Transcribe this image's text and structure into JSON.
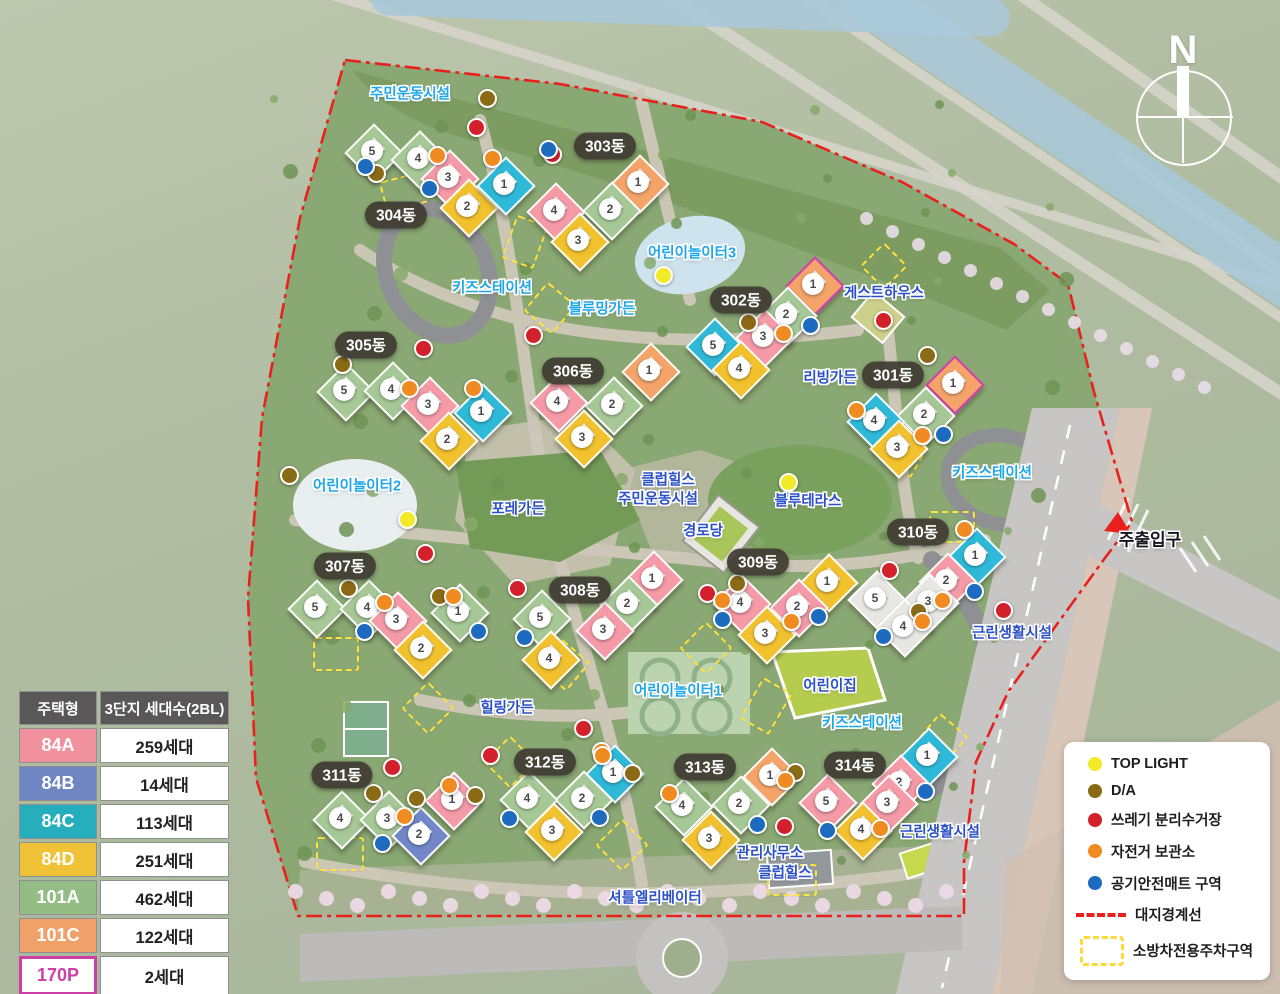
{
  "compass": {
    "letter": "N"
  },
  "unit_table": {
    "headers": [
      "주택형",
      "3단지 세대수(2BL)"
    ],
    "rows": [
      {
        "type": "84A",
        "count": "259세대",
        "color": "#f2919e",
        "text_color": "#ffffff"
      },
      {
        "type": "84B",
        "count": "14세대",
        "color": "#6f86c3",
        "text_color": "#ffffff"
      },
      {
        "type": "84C",
        "count": "113세대",
        "color": "#27aebd",
        "text_color": "#ffffff"
      },
      {
        "type": "84D",
        "count": "251세대",
        "color": "#f0c238",
        "text_color": "#ffffff"
      },
      {
        "type": "101A",
        "count": "462세대",
        "color": "#93bd85",
        "text_color": "#ffffff"
      },
      {
        "type": "101C",
        "count": "122세대",
        "color": "#f0a16a",
        "text_color": "#ffffff"
      },
      {
        "type": "170P",
        "count": "2세대",
        "color": "#ffffff",
        "text_color": "#cc3fa5",
        "border": "#cc3fa5"
      }
    ],
    "footer": "일반분양 1,223세대"
  },
  "legend": {
    "items": [
      {
        "kind": "dot",
        "color": "#f2ea29",
        "label": "TOP LIGHT"
      },
      {
        "kind": "dot",
        "color": "#8a6a15",
        "label": "D/A"
      },
      {
        "kind": "dot",
        "color": "#d2212a",
        "label": "쓰레기 분리수거장"
      },
      {
        "kind": "dot",
        "color": "#ef8b20",
        "label": "자전거 보관소"
      },
      {
        "kind": "dot",
        "color": "#1d6bbf",
        "label": "공기안전매트 구역"
      },
      {
        "kind": "dashline",
        "color": "#e8211d",
        "label": "대지경계선"
      },
      {
        "kind": "dashbox",
        "color": "#ffd83c",
        "label": "소방차전용주차구역"
      }
    ]
  },
  "unit_type_colors": {
    "84A": "#f59aa7",
    "84B": "#7287c8",
    "84C": "#2fb9d8",
    "84D": "#f2c12e",
    "101A": "#a6c896",
    "101C": "#f4a469",
    "170P": "#f4a469",
    "roof": "#e9e7e3"
  },
  "p170_border": "#cf3fae",
  "boundary_color": "#e8211d",
  "amenity_labels": [
    {
      "text": "주민운동시설",
      "x": 410,
      "y": 93,
      "style": "cyan"
    },
    {
      "text": "어린이놀이터3",
      "x": 692,
      "y": 252,
      "style": "cyan"
    },
    {
      "text": "키즈스테이션",
      "x": 492,
      "y": 287,
      "style": "cyan"
    },
    {
      "text": "블루밍가든",
      "x": 602,
      "y": 308,
      "style": "cyan"
    },
    {
      "text": "게스트하우스",
      "x": 884,
      "y": 292,
      "style": "blue"
    },
    {
      "text": "리빙가든",
      "x": 830,
      "y": 377,
      "style": "blue"
    },
    {
      "text": "어린이놀이터2",
      "x": 357,
      "y": 485,
      "style": "cyan"
    },
    {
      "text": "포레가든",
      "x": 518,
      "y": 508,
      "style": "blue"
    },
    {
      "text": "클럽힐스",
      "x": 668,
      "y": 479,
      "style": "blue"
    },
    {
      "text": "주민운동시설",
      "x": 658,
      "y": 498,
      "style": "blue"
    },
    {
      "text": "경로당",
      "x": 703,
      "y": 530,
      "style": "blue"
    },
    {
      "text": "블루테라스",
      "x": 808,
      "y": 500,
      "style": "blue"
    },
    {
      "text": "키즈스테이션",
      "x": 992,
      "y": 472,
      "style": "cyan"
    },
    {
      "text": "주출입구",
      "x": 1150,
      "y": 538,
      "style": "dark"
    },
    {
      "text": "근린생활시설",
      "x": 1012,
      "y": 632,
      "style": "blue"
    },
    {
      "text": "어린이놀이터1",
      "x": 678,
      "y": 690,
      "style": "cyan"
    },
    {
      "text": "어린이집",
      "x": 830,
      "y": 685,
      "style": "blue"
    },
    {
      "text": "키즈스테이션",
      "x": 862,
      "y": 722,
      "style": "cyan"
    },
    {
      "text": "힐링가든",
      "x": 507,
      "y": 707,
      "style": "blue"
    },
    {
      "text": "관리사무소",
      "x": 770,
      "y": 852,
      "style": "blue"
    },
    {
      "text": "클럽힐스",
      "x": 785,
      "y": 872,
      "style": "blue"
    },
    {
      "text": "근린생활시설",
      "x": 940,
      "y": 831,
      "style": "blue"
    },
    {
      "text": "셔틀엘리베이터",
      "x": 655,
      "y": 897,
      "style": "blue"
    }
  ],
  "buildings": [
    {
      "name": "303동",
      "pill": {
        "x": 605,
        "y": 146
      },
      "units": [
        {
          "n": "1",
          "t": "101C",
          "x": 638,
          "y": 182
        },
        {
          "n": "2",
          "t": "101A",
          "x": 610,
          "y": 209
        },
        {
          "n": "4",
          "t": "84A",
          "x": 554,
          "y": 210
        },
        {
          "n": "3",
          "t": "84D",
          "x": 578,
          "y": 240
        }
      ]
    },
    {
      "name": "304동",
      "pill": {
        "x": 396,
        "y": 215
      },
      "units": [
        {
          "n": "5",
          "t": "101A",
          "x": 372,
          "y": 151
        },
        {
          "n": "4",
          "t": "101A",
          "x": 418,
          "y": 158
        },
        {
          "n": "3",
          "t": "84A",
          "x": 448,
          "y": 177
        },
        {
          "n": "2",
          "t": "84D",
          "x": 467,
          "y": 206
        },
        {
          "n": "1",
          "t": "84C",
          "x": 504,
          "y": 184
        }
      ]
    },
    {
      "name": "302동",
      "pill": {
        "x": 741,
        "y": 300
      },
      "units": [
        {
          "n": "1",
          "t": "170P",
          "x": 813,
          "y": 284
        },
        {
          "n": "2",
          "t": "101A",
          "x": 786,
          "y": 314
        },
        {
          "n": "3",
          "t": "84A",
          "x": 763,
          "y": 336
        },
        {
          "n": "5",
          "t": "84C",
          "x": 713,
          "y": 345
        },
        {
          "n": "4",
          "t": "84D",
          "x": 739,
          "y": 368
        }
      ]
    },
    {
      "name": "305동",
      "pill": {
        "x": 366,
        "y": 345
      },
      "units": [
        {
          "n": "5",
          "t": "101A",
          "x": 344,
          "y": 390
        },
        {
          "n": "4",
          "t": "101A",
          "x": 391,
          "y": 389
        },
        {
          "n": "3",
          "t": "84A",
          "x": 428,
          "y": 404
        },
        {
          "n": "1",
          "t": "84C",
          "x": 481,
          "y": 411
        },
        {
          "n": "2",
          "t": "84D",
          "x": 447,
          "y": 439
        }
      ]
    },
    {
      "name": "306동",
      "pill": {
        "x": 573,
        "y": 371
      },
      "units": [
        {
          "n": "1",
          "t": "101C",
          "x": 649,
          "y": 370
        },
        {
          "n": "2",
          "t": "101A",
          "x": 612,
          "y": 404
        },
        {
          "n": "4",
          "t": "84A",
          "x": 557,
          "y": 401
        },
        {
          "n": "3",
          "t": "84D",
          "x": 582,
          "y": 437
        }
      ]
    },
    {
      "name": "301동",
      "pill": {
        "x": 893,
        "y": 375
      },
      "units": [
        {
          "n": "1",
          "t": "170P",
          "x": 953,
          "y": 383
        },
        {
          "n": "2",
          "t": "101A",
          "x": 924,
          "y": 414
        },
        {
          "n": "4",
          "t": "84C",
          "x": 874,
          "y": 420
        },
        {
          "n": "3",
          "t": "84D",
          "x": 897,
          "y": 447
        }
      ]
    },
    {
      "name": "307동",
      "pill": {
        "x": 345,
        "y": 566
      },
      "units": [
        {
          "n": "5",
          "t": "101A",
          "x": 315,
          "y": 607
        },
        {
          "n": "4",
          "t": "101A",
          "x": 367,
          "y": 607
        },
        {
          "n": "3",
          "t": "84A",
          "x": 396,
          "y": 619
        },
        {
          "n": "1",
          "t": "101A",
          "x": 458,
          "y": 611
        },
        {
          "n": "2",
          "t": "84D",
          "x": 421,
          "y": 648
        }
      ]
    },
    {
      "name": "308동",
      "pill": {
        "x": 580,
        "y": 590
      },
      "units": [
        {
          "n": "1",
          "t": "84A",
          "x": 652,
          "y": 578
        },
        {
          "n": "2",
          "t": "101A",
          "x": 627,
          "y": 603
        },
        {
          "n": "5",
          "t": "101A",
          "x": 540,
          "y": 617
        },
        {
          "n": "3",
          "t": "84A",
          "x": 603,
          "y": 629
        },
        {
          "n": "4",
          "t": "84D",
          "x": 549,
          "y": 658
        }
      ]
    },
    {
      "name": "309동",
      "pill": {
        "x": 758,
        "y": 562
      },
      "units": [
        {
          "n": "1",
          "t": "84D",
          "x": 827,
          "y": 581
        },
        {
          "n": "2",
          "t": "84A",
          "x": 797,
          "y": 606
        },
        {
          "n": "4",
          "t": "84A",
          "x": 740,
          "y": 602
        },
        {
          "n": "3",
          "t": "84D",
          "x": 765,
          "y": 633
        }
      ]
    },
    {
      "name": "310동",
      "pill": {
        "x": 918,
        "y": 532
      },
      "units": [
        {
          "n": "1",
          "t": "84C",
          "x": 975,
          "y": 555
        },
        {
          "n": "2",
          "t": "84A",
          "x": 946,
          "y": 580
        },
        {
          "n": "3",
          "t": "roof",
          "x": 928,
          "y": 601
        },
        {
          "n": "5",
          "t": "roof",
          "x": 875,
          "y": 598
        },
        {
          "n": "4",
          "t": "roof",
          "x": 903,
          "y": 626
        }
      ]
    },
    {
      "name": "311동",
      "pill": {
        "x": 342,
        "y": 775
      },
      "units": [
        {
          "n": "4",
          "t": "101A",
          "x": 340,
          "y": 818
        },
        {
          "n": "3",
          "t": "101A",
          "x": 387,
          "y": 818
        },
        {
          "n": "1",
          "t": "84A",
          "x": 452,
          "y": 799
        },
        {
          "n": "2",
          "t": "84B",
          "x": 419,
          "y": 834
        }
      ]
    },
    {
      "name": "312동",
      "pill": {
        "x": 545,
        "y": 762
      },
      "units": [
        {
          "n": "1",
          "t": "84C",
          "x": 613,
          "y": 772
        },
        {
          "n": "2",
          "t": "101A",
          "x": 582,
          "y": 798
        },
        {
          "n": "4",
          "t": "101A",
          "x": 527,
          "y": 798
        },
        {
          "n": "3",
          "t": "84D",
          "x": 552,
          "y": 830
        }
      ]
    },
    {
      "name": "313동",
      "pill": {
        "x": 705,
        "y": 767
      },
      "units": [
        {
          "n": "1",
          "t": "101C",
          "x": 770,
          "y": 775
        },
        {
          "n": "2",
          "t": "101A",
          "x": 739,
          "y": 803
        },
        {
          "n": "4",
          "t": "101A",
          "x": 682,
          "y": 805
        },
        {
          "n": "3",
          "t": "84D",
          "x": 709,
          "y": 838
        }
      ]
    },
    {
      "name": "314동",
      "pill": {
        "x": 855,
        "y": 765
      },
      "units": [
        {
          "n": "1",
          "t": "84C",
          "x": 927,
          "y": 755
        },
        {
          "n": "2",
          "t": "84A",
          "x": 899,
          "y": 782
        },
        {
          "n": "3",
          "t": "84A",
          "x": 887,
          "y": 802
        },
        {
          "n": "5",
          "t": "84A",
          "x": 826,
          "y": 801
        },
        {
          "n": "4",
          "t": "84D",
          "x": 861,
          "y": 829
        }
      ]
    }
  ],
  "dot_colors": {
    "y": "#f2ea29",
    "b": "#8a6a15",
    "r": "#d2212a",
    "o": "#ef8b20",
    "u": "#1d6bbf"
  },
  "facility_dots": [
    {
      "t": "b",
      "x": 487,
      "y": 98
    },
    {
      "t": "b",
      "x": 376,
      "y": 173
    },
    {
      "t": "b",
      "x": 748,
      "y": 322
    },
    {
      "t": "b",
      "x": 342,
      "y": 364
    },
    {
      "t": "b",
      "x": 927,
      "y": 355
    },
    {
      "t": "b",
      "x": 289,
      "y": 475
    },
    {
      "t": "b",
      "x": 348,
      "y": 588
    },
    {
      "t": "b",
      "x": 439,
      "y": 596
    },
    {
      "t": "b",
      "x": 737,
      "y": 583
    },
    {
      "t": "b",
      "x": 918,
      "y": 611
    },
    {
      "t": "b",
      "x": 795,
      "y": 772
    },
    {
      "t": "b",
      "x": 373,
      "y": 793
    },
    {
      "t": "b",
      "x": 416,
      "y": 798
    },
    {
      "t": "b",
      "x": 475,
      "y": 795
    },
    {
      "t": "b",
      "x": 632,
      "y": 773
    },
    {
      "t": "r",
      "x": 476,
      "y": 127
    },
    {
      "t": "r",
      "x": 552,
      "y": 154
    },
    {
      "t": "r",
      "x": 533,
      "y": 335
    },
    {
      "t": "r",
      "x": 423,
      "y": 348
    },
    {
      "t": "r",
      "x": 883,
      "y": 320
    },
    {
      "t": "r",
      "x": 425,
      "y": 553
    },
    {
      "t": "r",
      "x": 517,
      "y": 588
    },
    {
      "t": "r",
      "x": 707,
      "y": 593
    },
    {
      "t": "r",
      "x": 889,
      "y": 570
    },
    {
      "t": "r",
      "x": 1003,
      "y": 610
    },
    {
      "t": "r",
      "x": 392,
      "y": 767
    },
    {
      "t": "r",
      "x": 490,
      "y": 755
    },
    {
      "t": "r",
      "x": 583,
      "y": 728
    },
    {
      "t": "r",
      "x": 784,
      "y": 826
    },
    {
      "t": "o",
      "x": 437,
      "y": 155
    },
    {
      "t": "o",
      "x": 492,
      "y": 158
    },
    {
      "t": "o",
      "x": 409,
      "y": 388
    },
    {
      "t": "o",
      "x": 473,
      "y": 388
    },
    {
      "t": "o",
      "x": 783,
      "y": 333
    },
    {
      "t": "o",
      "x": 856,
      "y": 410
    },
    {
      "t": "o",
      "x": 922,
      "y": 435
    },
    {
      "t": "o",
      "x": 964,
      "y": 529
    },
    {
      "t": "o",
      "x": 384,
      "y": 602
    },
    {
      "t": "o",
      "x": 453,
      "y": 596
    },
    {
      "t": "o",
      "x": 722,
      "y": 600
    },
    {
      "t": "o",
      "x": 791,
      "y": 621
    },
    {
      "t": "o",
      "x": 942,
      "y": 600
    },
    {
      "t": "o",
      "x": 922,
      "y": 621
    },
    {
      "t": "o",
      "x": 601,
      "y": 751
    },
    {
      "t": "o",
      "x": 669,
      "y": 793
    },
    {
      "t": "o",
      "x": 785,
      "y": 780
    },
    {
      "t": "o",
      "x": 880,
      "y": 828
    },
    {
      "t": "o",
      "x": 404,
      "y": 816
    },
    {
      "t": "o",
      "x": 449,
      "y": 785
    },
    {
      "t": "o",
      "x": 602,
      "y": 755
    },
    {
      "t": "u",
      "x": 365,
      "y": 166
    },
    {
      "t": "u",
      "x": 429,
      "y": 188
    },
    {
      "t": "u",
      "x": 548,
      "y": 149
    },
    {
      "t": "u",
      "x": 810,
      "y": 325
    },
    {
      "t": "u",
      "x": 943,
      "y": 434
    },
    {
      "t": "u",
      "x": 364,
      "y": 631
    },
    {
      "t": "u",
      "x": 478,
      "y": 631
    },
    {
      "t": "u",
      "x": 524,
      "y": 637
    },
    {
      "t": "u",
      "x": 722,
      "y": 619
    },
    {
      "t": "u",
      "x": 818,
      "y": 616
    },
    {
      "t": "u",
      "x": 883,
      "y": 636
    },
    {
      "t": "u",
      "x": 974,
      "y": 591
    },
    {
      "t": "u",
      "x": 757,
      "y": 824
    },
    {
      "t": "u",
      "x": 827,
      "y": 830
    },
    {
      "t": "u",
      "x": 925,
      "y": 791
    },
    {
      "t": "u",
      "x": 382,
      "y": 843
    },
    {
      "t": "u",
      "x": 509,
      "y": 818
    },
    {
      "t": "u",
      "x": 599,
      "y": 817
    },
    {
      "t": "y",
      "x": 663,
      "y": 275
    },
    {
      "t": "y",
      "x": 407,
      "y": 519
    },
    {
      "t": "y",
      "x": 788,
      "y": 482
    }
  ],
  "fire_lanes": [
    {
      "x": 402,
      "y": 190,
      "w": 40,
      "h": 28,
      "r": -15
    },
    {
      "x": 523,
      "y": 240,
      "w": 30,
      "h": 42,
      "r": 20
    },
    {
      "x": 548,
      "y": 306,
      "w": 34,
      "h": 34,
      "r": 40
    },
    {
      "x": 882,
      "y": 264,
      "w": 30,
      "h": 30,
      "r": 45
    },
    {
      "x": 902,
      "y": 452,
      "w": 32,
      "h": 32,
      "r": 30
    },
    {
      "x": 950,
      "y": 525,
      "w": 42,
      "h": 28,
      "r": 0
    },
    {
      "x": 334,
      "y": 652,
      "w": 42,
      "h": 30,
      "r": 0
    },
    {
      "x": 426,
      "y": 706,
      "w": 34,
      "h": 34,
      "r": 45
    },
    {
      "x": 562,
      "y": 663,
      "w": 34,
      "h": 34,
      "r": 40
    },
    {
      "x": 704,
      "y": 646,
      "w": 34,
      "h": 34,
      "r": 45
    },
    {
      "x": 764,
      "y": 704,
      "w": 30,
      "h": 44,
      "r": 30
    },
    {
      "x": 620,
      "y": 843,
      "w": 34,
      "h": 34,
      "r": 45
    },
    {
      "x": 790,
      "y": 878,
      "w": 46,
      "h": 28,
      "r": 0
    },
    {
      "x": 338,
      "y": 852,
      "w": 44,
      "h": 30,
      "r": 0
    },
    {
      "x": 940,
      "y": 737,
      "w": 34,
      "h": 34,
      "r": 40
    },
    {
      "x": 508,
      "y": 760,
      "w": 34,
      "h": 34,
      "r": 45
    }
  ]
}
